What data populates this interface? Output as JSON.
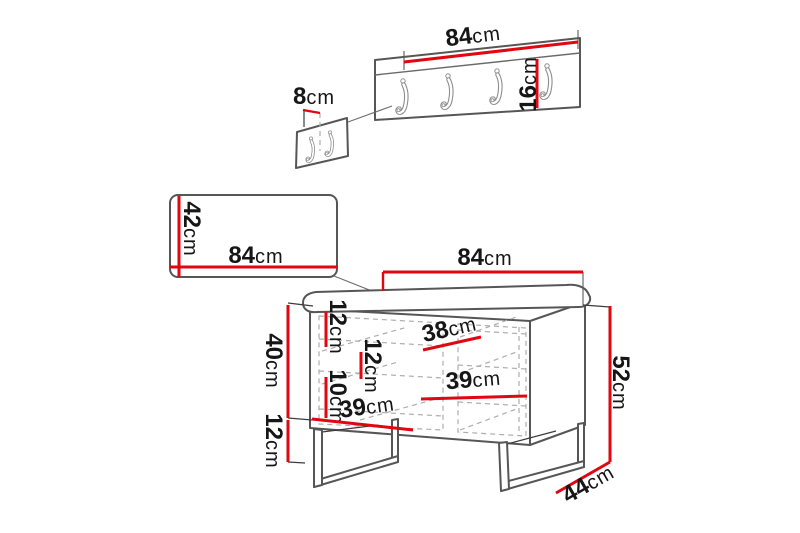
{
  "colors": {
    "dimension_red": "#e1060f",
    "outline_gray": "#565656",
    "dashed_gray": "#adadad",
    "label_black": "#161616"
  },
  "diagram": {
    "type": "furniture-dimension-diagram",
    "pieces": {
      "rack": {
        "description": "wall coat rack with 4 hooks",
        "hook_count": 4,
        "width": {
          "value": "84",
          "unit": "cm"
        },
        "height": {
          "value": "16",
          "unit": "cm"
        }
      },
      "rack_side": {
        "description": "coat rack side view with 2 hooks",
        "hook_count": 2,
        "depth": {
          "value": "8",
          "unit": "cm"
        }
      },
      "panel": {
        "description": "wall panel",
        "height": {
          "value": "42",
          "unit": "cm"
        },
        "width": {
          "value": "84",
          "unit": "cm"
        }
      },
      "bench": {
        "description": "storage shoe bench with cushion and metal legs",
        "width": {
          "value": "84",
          "unit": "cm"
        },
        "height": {
          "value": "52",
          "unit": "cm"
        },
        "depth": {
          "value": "44",
          "unit": "cm"
        },
        "body_height": {
          "value": "40",
          "unit": "cm"
        },
        "leg_height": {
          "value": "12",
          "unit": "cm"
        },
        "top_gap": {
          "value": "12",
          "unit": "cm"
        },
        "middle_gap": {
          "value": "12",
          "unit": "cm"
        },
        "bottom_gap": {
          "value": "10",
          "unit": "cm"
        },
        "top_shelf_width": {
          "value": "38",
          "unit": "cm"
        },
        "middle_shelf_width": {
          "value": "39",
          "unit": "cm"
        },
        "bottom_shelf_width": {
          "value": "39",
          "unit": "cm"
        }
      }
    }
  }
}
